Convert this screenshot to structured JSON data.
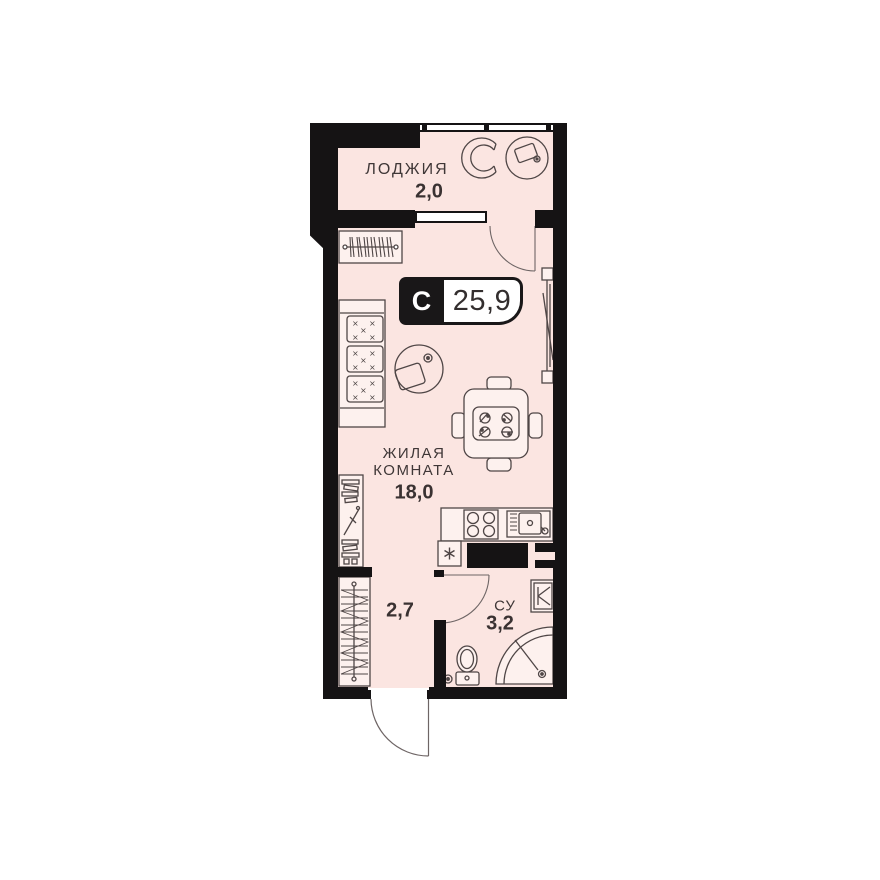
{
  "floorplan": {
    "badge": {
      "letter": "С",
      "total_area": "25,9"
    },
    "rooms": {
      "loggia": {
        "name": "ЛОДЖИЯ",
        "area": "2,0"
      },
      "living": {
        "name_line1": "ЖИЛАЯ",
        "name_line2": "КОМНАТА",
        "area": "18,0"
      },
      "hallway": {
        "area": "2,7"
      },
      "bathroom": {
        "name": "СУ",
        "area": "3,2"
      }
    },
    "colors": {
      "wall": "#151314",
      "floor": "#fbe5e1",
      "furniture_line": "#4f4646",
      "furniture_fill": "#fdf1ee",
      "badge_bg": "#191718",
      "badge_text": "#332e2e",
      "label_text": "#3f3737",
      "paper": "#ffffff"
    },
    "icons": {
      "fridge_glyph": "asterisk-snowflake",
      "wardrobe_glyph": "hanger-rod",
      "shower_glyph": "quarter-circle-tray",
      "washing_machine_glyph": "square-with-k-valve"
    }
  }
}
